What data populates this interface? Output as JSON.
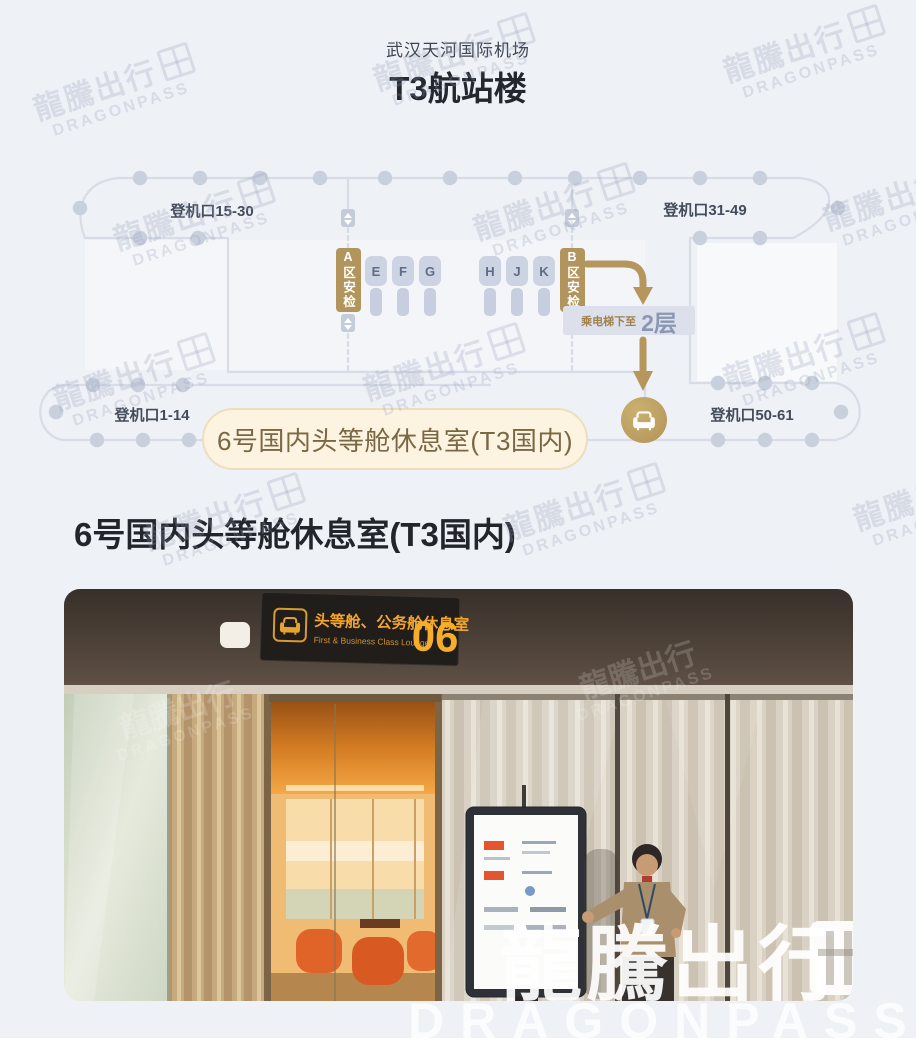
{
  "page": {
    "airport": "武汉天河国际机场",
    "terminal_title": "T3航站楼",
    "section_title": "6号国内头等舱休息室(T3国内)"
  },
  "watermark": {
    "cn": "龍騰出行",
    "en": "DRAGONPASS",
    "tiles": [
      {
        "x": 10,
        "y": 60
      },
      {
        "x": 350,
        "y": 30
      },
      {
        "x": 700,
        "y": 22
      },
      {
        "x": 90,
        "y": 190
      },
      {
        "x": 450,
        "y": 180
      },
      {
        "x": 800,
        "y": 170
      },
      {
        "x": 30,
        "y": 350
      },
      {
        "x": 340,
        "y": 340
      },
      {
        "x": 700,
        "y": 330
      },
      {
        "x": 120,
        "y": 490
      },
      {
        "x": 480,
        "y": 480
      },
      {
        "x": 830,
        "y": 470
      }
    ]
  },
  "map": {
    "gate_labels": {
      "top_left": "登机口15-30",
      "top_right": "登机口31-49",
      "bottom_left": "登机口1-14",
      "bottom_right": "登机口50-61"
    },
    "security_a": "A区安检",
    "security_b": "B区安检",
    "piers": [
      "E",
      "F",
      "G",
      "H",
      "J",
      "K"
    ],
    "elevator_note": "乘电梯下至",
    "floor": "2层",
    "lounge_callout": "6号国内头等舱休息室(T3国内)"
  },
  "photo": {
    "sign": {
      "cn": "头等舱、公务舱休息室",
      "en": "First & Business Class Lounge",
      "number": "06"
    }
  },
  "colors": {
    "page_bg": "#eef1f6",
    "map_line": "#d7dce7",
    "map_dot": "#c9d0dd",
    "accent_tan": "#b2935a",
    "pill_bg": "#fdf3e1",
    "pill_text": "#7a6743",
    "floor_badge_bg": "#dbe0eb",
    "floor_text": "#8b97b2",
    "sign_amber": "#f2a42c"
  }
}
